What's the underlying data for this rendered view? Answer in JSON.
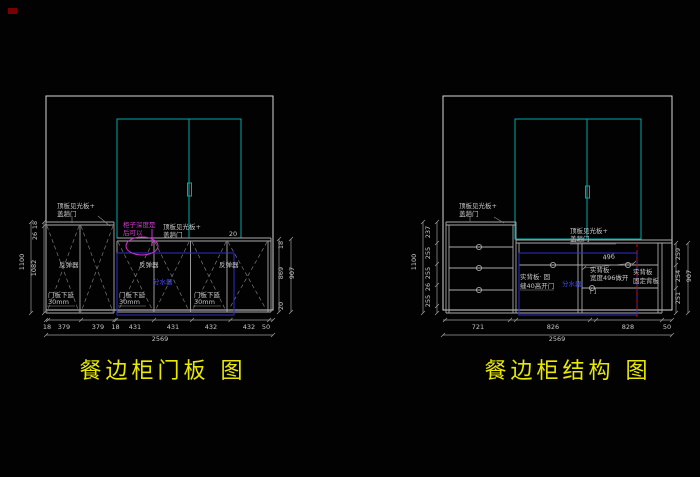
{
  "titles": {
    "left": "餐边柜门板 图",
    "right": "餐边柜结构 图"
  },
  "shared": {
    "top_panel_note_line1": "顶板见光板+",
    "top_panel_note_line2": "盖趟门"
  },
  "left": {
    "rebound": "反弹器",
    "door_drop_line1": "门板下延",
    "door_drop_line2": "30mm",
    "blue_label": "分水器",
    "magenta_line1": "柜子深度是",
    "magenta_line2": "后可以",
    "gap_dim": "20",
    "dims_bottom": [
      "18",
      "379",
      "379",
      "18",
      "431",
      "431",
      "432",
      "432",
      "50"
    ],
    "dim_total": "2569",
    "dims_left": [
      "18",
      "26",
      "1082"
    ],
    "dim_left_total": "1100",
    "dims_right": [
      "18",
      "869",
      "20"
    ],
    "dim_right_total": "907"
  },
  "right": {
    "blue_label": "分水器",
    "back_note1_line1": "实背板· 固",
    "back_note1_line2": "缝40高开门",
    "back_note2_line1": "实背板·",
    "back_note2_line2": "宽度496做开",
    "back_note2_line3": "门",
    "back_note3_line1": "实背板",
    "back_note3_line2": "固定背板",
    "dim_496": "496",
    "dims_bottom": [
      "721",
      "826",
      "828",
      "50"
    ],
    "dim_total": "2569",
    "dims_left": [
      "237",
      "255",
      "255",
      "26",
      "255"
    ],
    "dim_left_total": "1100",
    "dims_right": [
      "259",
      "254",
      "251"
    ],
    "dim_right_total": "907"
  },
  "colors": {
    "background": "#000000",
    "line": "#c9c9c9",
    "cyan": "#00a8a8",
    "magenta": "#cf2fcf",
    "blue": "#2d2dc8",
    "blue_text": "#4646ff",
    "red": "#c01010",
    "title_yellow": "#e8e800",
    "corner_marker": "#7a0000"
  }
}
